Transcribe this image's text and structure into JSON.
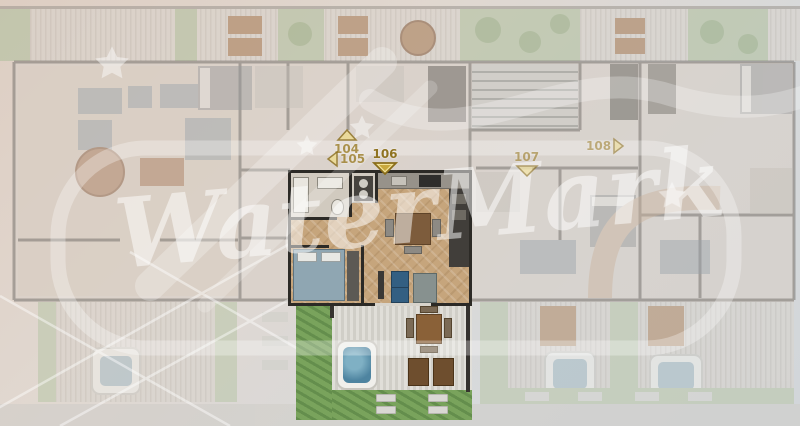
{
  "page": {
    "title": "Residential floor plan with highlighted unit"
  },
  "watermark": {
    "text": "WaterMark"
  },
  "units": {
    "highlighted_id": "106",
    "labels": [
      {
        "id": "104",
        "direction": "up"
      },
      {
        "id": "105",
        "direction": "left"
      },
      {
        "id": "106",
        "direction": "down",
        "highlighted": true
      },
      {
        "id": "107",
        "direction": "down"
      },
      {
        "id": "108",
        "direction": "right"
      }
    ]
  },
  "colors": {
    "label_gold_text": "#8f7320",
    "label_arrow_fill": "#eedd8f",
    "label_arrow_border": "#8a6d1a",
    "unit_wall": "#2c2a26",
    "unit_floor_wood": "#c6a57c",
    "bed_blue": "#8fa6b2",
    "sofa_blue": "#335f82",
    "grass_green": "#79a35c",
    "hot_tub_water": "#4e84a0",
    "faded_plan": "#d7cec6",
    "watermark_white": "#ffffff"
  }
}
